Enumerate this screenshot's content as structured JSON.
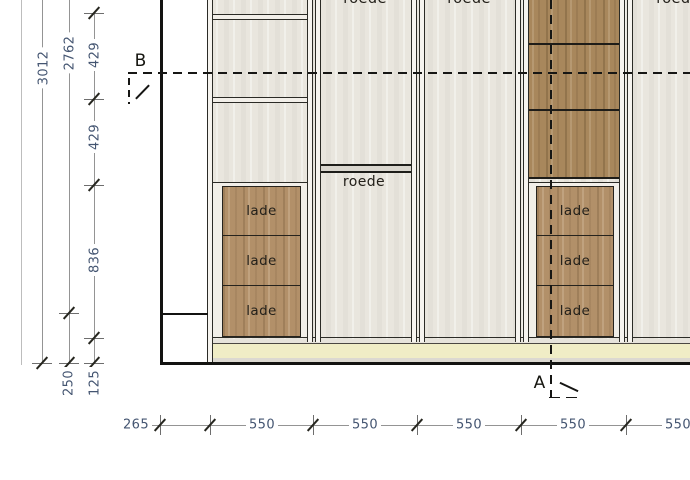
{
  "labels": {
    "section_a": "A",
    "section_b": "B"
  },
  "dimensions": {
    "vertical": [
      {
        "label": "3012"
      },
      {
        "label": "2762"
      },
      {
        "label": "429"
      },
      {
        "label": "429"
      },
      {
        "label": "836"
      },
      {
        "label": "250"
      },
      {
        "label": "125"
      }
    ],
    "horizontal": [
      {
        "label": "265"
      },
      {
        "label": "550"
      },
      {
        "label": "550"
      },
      {
        "label": "550"
      },
      {
        "label": "550"
      },
      {
        "label": "550"
      }
    ]
  },
  "cabinet": {
    "top_rod_labels": [
      "roede",
      "roede",
      "roede"
    ],
    "mid_rod_label": "roede",
    "drawer_stacks": [
      {
        "drawers": [
          "lade",
          "lade",
          "lade"
        ]
      },
      {
        "drawers": [
          "lade",
          "lade",
          "lade"
        ]
      }
    ]
  },
  "colors": {
    "dimension_text": "#445571",
    "drawing_line": "#1c1c1a",
    "interior": "#e9e6de",
    "wood": "#a8875c",
    "drawer_wood": "#b29069",
    "plinth_cream": "#f0edc6"
  }
}
